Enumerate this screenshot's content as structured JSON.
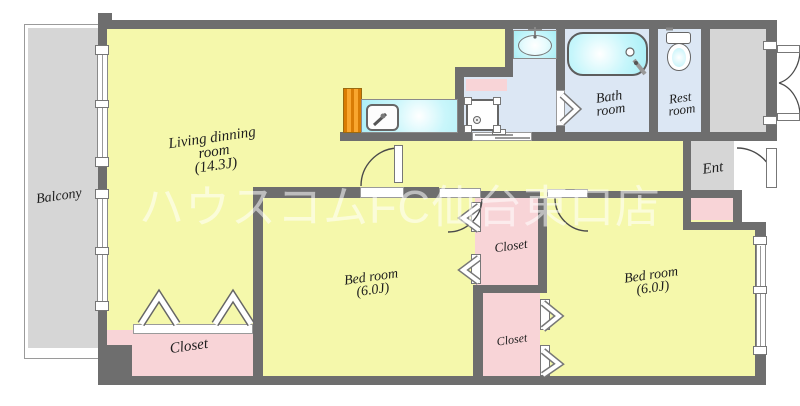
{
  "watermark": {
    "text": "ハウスコムFC仙台東口店"
  },
  "rooms": {
    "balcony": {
      "label": "Balcony"
    },
    "living": {
      "line1": "Living dinning",
      "line2": "room",
      "line3": "(14.3J)"
    },
    "bedroom_center": {
      "line1": "Bed room",
      "line2": "(6.0J)"
    },
    "bedroom_right": {
      "line1": "Bed room",
      "line2": "(6.0J)"
    },
    "bath": {
      "line1": "Bath",
      "line2": "room"
    },
    "rest": {
      "line1": "Rest",
      "line2": "room"
    },
    "entrance": {
      "label": "Ent"
    },
    "closet_living": {
      "label": "Closet"
    },
    "closet_upper": {
      "label": "Closet"
    },
    "closet_lower": {
      "label": "Closet"
    }
  },
  "fixtures": {
    "kitchen": [
      "refrigerator",
      "kitchen-sink-counter"
    ],
    "washroom": [
      "wash-basin",
      "washing-machine-pan",
      "shelf"
    ],
    "bath": [
      "bathtub"
    ],
    "rest": [
      "toilet"
    ]
  },
  "colors": {
    "wall": "#6e6e6e",
    "room_yellow": "#f5f8ab",
    "floor_blue": "#dce7f4",
    "closet_pink": "#f8d4d7",
    "fixture_cyan": "#b5f1f8",
    "outdoor_gray": "#d6d6d6",
    "appliance_orange": "#f9a62e",
    "watermark_white": "#ffffff"
  }
}
